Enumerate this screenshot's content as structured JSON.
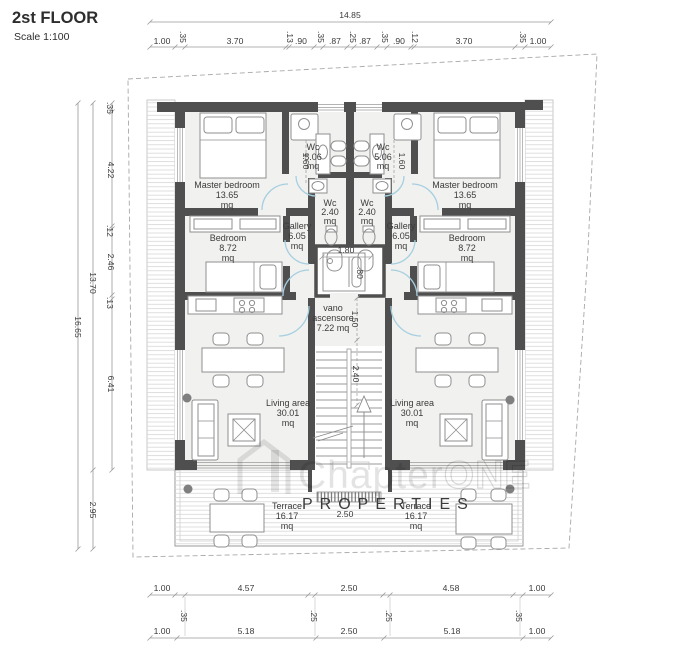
{
  "header": {
    "title": "2st FLOOR",
    "scale": "Scale 1:100"
  },
  "watermark": {
    "brand_a": "Chapter",
    "brand_b": "ONE",
    "line2": "PROPERTIES"
  },
  "rooms": {
    "master_bedroom": {
      "label": "Master bedroom",
      "area": "13.65",
      "unit": "mq"
    },
    "wc_large": {
      "label": "Wc",
      "area": "5.06",
      "unit": "mq"
    },
    "wc_small": {
      "label": "Wc",
      "area": "2.40",
      "unit": "mq"
    },
    "gallery": {
      "label": "Gallery",
      "area": "6.05",
      "unit": "mq"
    },
    "bedroom": {
      "label": "Bedroom",
      "area": "8.72",
      "unit": "mq"
    },
    "living": {
      "label": "Living area",
      "area": "30.01",
      "unit": "mq"
    },
    "terrace": {
      "label": "Terrace",
      "area": "16.17",
      "unit": "mq"
    },
    "elevator": {
      "label_1": "vano",
      "label_2": "ascensore",
      "area": "7.22 mq"
    }
  },
  "dimensions": {
    "top_overall": "14.85",
    "top_row": [
      "1.00",
      ".35",
      "3.70",
      ".13",
      ".90",
      ".35",
      ".87",
      ".25",
      ".87",
      ".35",
      ".90",
      ".12",
      "3.70",
      ".35",
      "1.00"
    ],
    "left_outer": "16.65",
    "left_inner": "13.70",
    "left_terrace": "2.95",
    "left_segments": [
      ".35",
      "4.22",
      ".12",
      "2.46",
      ".13",
      "6.41"
    ],
    "bottom_row1": [
      "1.00",
      ".35",
      "4.57",
      ".25",
      "2.50",
      ".25",
      "4.58",
      ".35",
      "1.00"
    ],
    "bottom_row2": [
      "1.00",
      "5.18",
      "2.50",
      "5.18",
      "1.00"
    ],
    "wc_width": "1.60",
    "elevator_width": "1.80",
    "elevator_door": ".80",
    "lobby_depth": "1.50",
    "stair_depth": "2.40",
    "terrace_opening": "2.50"
  },
  "colors": {
    "wall": "#4f4f4f",
    "door_arc": "#a5cfe0",
    "floor": "#f1f1ef",
    "column": "#7f7f7f"
  }
}
